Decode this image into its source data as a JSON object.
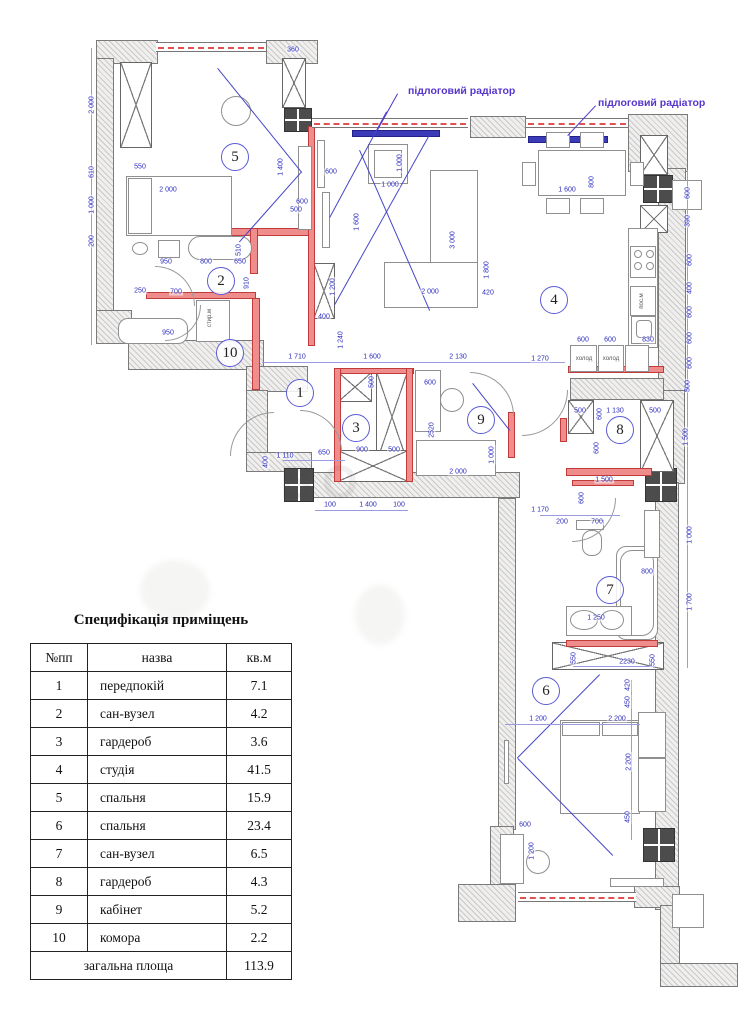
{
  "colors": {
    "dimension_blue": "#2a2ac0",
    "wall_red": "#ef8d8d",
    "radiator_blue": "#3b3bb8",
    "label_violet": "#5535cc"
  },
  "plan": {
    "watermark": "ВО",
    "radiator_labels": [
      {
        "t": "підлоговий радіатор",
        "x": 408,
        "y": 85
      },
      {
        "t": "підлоговий радіатор",
        "x": 598,
        "y": 97
      }
    ],
    "rooms": [
      {
        "n": "1",
        "x": 300,
        "y": 393
      },
      {
        "n": "2",
        "x": 221,
        "y": 281
      },
      {
        "n": "3",
        "x": 356,
        "y": 428
      },
      {
        "n": "4",
        "x": 554,
        "y": 300
      },
      {
        "n": "5",
        "x": 235,
        "y": 157
      },
      {
        "n": "6",
        "x": 546,
        "y": 691
      },
      {
        "n": "7",
        "x": 610,
        "y": 590
      },
      {
        "n": "8",
        "x": 620,
        "y": 430
      },
      {
        "n": "9",
        "x": 481,
        "y": 420
      },
      {
        "n": "10",
        "x": 230,
        "y": 353
      }
    ],
    "small_labels": [
      {
        "t": "стир.м",
        "x": 210,
        "y": 318,
        "v": 1
      },
      {
        "t": "пос.м",
        "x": 642,
        "y": 301,
        "v": 1
      },
      {
        "t": "холод",
        "x": 584,
        "y": 359
      },
      {
        "t": "холод",
        "x": 611,
        "y": 359
      }
    ],
    "dims": [
      {
        "t": "2 000",
        "x": 92,
        "y": 105,
        "v": 1
      },
      {
        "t": "610",
        "x": 92,
        "y": 172,
        "v": 1
      },
      {
        "t": "1 000",
        "x": 92,
        "y": 205,
        "v": 1
      },
      {
        "t": "200",
        "x": 92,
        "y": 241,
        "v": 1
      },
      {
        "t": "550",
        "x": 140,
        "y": 167
      },
      {
        "t": "2 000",
        "x": 168,
        "y": 190
      },
      {
        "t": "360",
        "x": 293,
        "y": 50
      },
      {
        "t": "1 400",
        "x": 281,
        "y": 167,
        "v": 1
      },
      {
        "t": "600",
        "x": 331,
        "y": 172
      },
      {
        "t": "600",
        "x": 302,
        "y": 202
      },
      {
        "t": "500",
        "x": 296,
        "y": 210
      },
      {
        "t": "250",
        "x": 140,
        "y": 291
      },
      {
        "t": "950",
        "x": 166,
        "y": 262
      },
      {
        "t": "800",
        "x": 206,
        "y": 262
      },
      {
        "t": "650",
        "x": 240,
        "y": 262
      },
      {
        "t": "510",
        "x": 239,
        "y": 250,
        "v": 1
      },
      {
        "t": "910",
        "x": 247,
        "y": 283,
        "v": 1
      },
      {
        "t": "700",
        "x": 176,
        "y": 292
      },
      {
        "t": "950",
        "x": 168,
        "y": 333
      },
      {
        "t": "1 200",
        "x": 333,
        "y": 287,
        "v": 1
      },
      {
        "t": "400",
        "x": 324,
        "y": 317
      },
      {
        "t": "1 240",
        "x": 341,
        "y": 340,
        "v": 1
      },
      {
        "t": "1 710",
        "x": 297,
        "y": 357
      },
      {
        "t": "1 600",
        "x": 372,
        "y": 357
      },
      {
        "t": "2 130",
        "x": 458,
        "y": 357
      },
      {
        "t": "1 270",
        "x": 540,
        "y": 359
      },
      {
        "t": "1 110",
        "x": 285,
        "y": 456
      },
      {
        "t": "650",
        "x": 324,
        "y": 453
      },
      {
        "t": "400",
        "x": 266,
        "y": 462,
        "v": 1
      },
      {
        "t": "900",
        "x": 362,
        "y": 450
      },
      {
        "t": "500",
        "x": 394,
        "y": 450
      },
      {
        "t": "500",
        "x": 372,
        "y": 382,
        "v": 1
      },
      {
        "t": "100",
        "x": 330,
        "y": 505
      },
      {
        "t": "1 400",
        "x": 368,
        "y": 505
      },
      {
        "t": "100",
        "x": 399,
        "y": 505
      },
      {
        "t": "600",
        "x": 430,
        "y": 383
      },
      {
        "t": "2520",
        "x": 432,
        "y": 430,
        "v": 1
      },
      {
        "t": "2 000",
        "x": 458,
        "y": 472
      },
      {
        "t": "1 000",
        "x": 492,
        "y": 455,
        "v": 1
      },
      {
        "t": "1 000",
        "x": 390,
        "y": 185
      },
      {
        "t": "1 000",
        "x": 400,
        "y": 163,
        "v": 1
      },
      {
        "t": "1 600",
        "x": 357,
        "y": 222,
        "v": 1
      },
      {
        "t": "3 000",
        "x": 453,
        "y": 240,
        "v": 1
      },
      {
        "t": "1 800",
        "x": 487,
        "y": 270,
        "v": 1
      },
      {
        "t": "2 000",
        "x": 430,
        "y": 292
      },
      {
        "t": "420",
        "x": 488,
        "y": 293
      },
      {
        "t": "1 600",
        "x": 567,
        "y": 190
      },
      {
        "t": "800",
        "x": 592,
        "y": 182,
        "v": 1
      },
      {
        "t": "600",
        "x": 688,
        "y": 193,
        "v": 1
      },
      {
        "t": "390",
        "x": 688,
        "y": 221,
        "v": 1
      },
      {
        "t": "600",
        "x": 690,
        "y": 260,
        "v": 1
      },
      {
        "t": "400",
        "x": 690,
        "y": 288,
        "v": 1
      },
      {
        "t": "600",
        "x": 690,
        "y": 312,
        "v": 1
      },
      {
        "t": "600",
        "x": 690,
        "y": 338,
        "v": 1
      },
      {
        "t": "600",
        "x": 690,
        "y": 363,
        "v": 1
      },
      {
        "t": "500",
        "x": 688,
        "y": 386,
        "v": 1
      },
      {
        "t": "830",
        "x": 648,
        "y": 340
      },
      {
        "t": "600",
        "x": 583,
        "y": 340
      },
      {
        "t": "600",
        "x": 610,
        "y": 340
      },
      {
        "t": "500",
        "x": 580,
        "y": 411
      },
      {
        "t": "1 130",
        "x": 615,
        "y": 411
      },
      {
        "t": "500",
        "x": 655,
        "y": 411
      },
      {
        "t": "600",
        "x": 600,
        "y": 414,
        "v": 1
      },
      {
        "t": "1 500",
        "x": 686,
        "y": 437,
        "v": 1
      },
      {
        "t": "600",
        "x": 597,
        "y": 448,
        "v": 1
      },
      {
        "t": "1 500",
        "x": 604,
        "y": 480
      },
      {
        "t": "1 170",
        "x": 540,
        "y": 510
      },
      {
        "t": "200",
        "x": 562,
        "y": 522
      },
      {
        "t": "700",
        "x": 597,
        "y": 522
      },
      {
        "t": "600",
        "x": 582,
        "y": 498,
        "v": 1
      },
      {
        "t": "1 000",
        "x": 690,
        "y": 535,
        "v": 1
      },
      {
        "t": "800",
        "x": 647,
        "y": 572
      },
      {
        "t": "1 700",
        "x": 690,
        "y": 602,
        "v": 1
      },
      {
        "t": "1 250",
        "x": 596,
        "y": 618
      },
      {
        "t": "550",
        "x": 574,
        "y": 658,
        "v": 1
      },
      {
        "t": "2230",
        "x": 627,
        "y": 662
      },
      {
        "t": "550",
        "x": 653,
        "y": 660,
        "v": 1
      },
      {
        "t": "420",
        "x": 628,
        "y": 685,
        "v": 1
      },
      {
        "t": "450",
        "x": 628,
        "y": 702,
        "v": 1
      },
      {
        "t": "1 200",
        "x": 538,
        "y": 719
      },
      {
        "t": "2 200",
        "x": 617,
        "y": 719
      },
      {
        "t": "2 200",
        "x": 629,
        "y": 762,
        "v": 1
      },
      {
        "t": "450",
        "x": 628,
        "y": 817,
        "v": 1
      },
      {
        "t": "600",
        "x": 525,
        "y": 825
      },
      {
        "t": "1 200",
        "x": 532,
        "y": 851,
        "v": 1
      }
    ]
  },
  "spec": {
    "title": "Специфікація приміщень",
    "columns": [
      "№пп",
      "назва",
      "кв.м"
    ],
    "rows": [
      [
        "1",
        "передпокій",
        "7.1"
      ],
      [
        "2",
        "сан-вузел",
        "4.2"
      ],
      [
        "3",
        "гардероб",
        "3.6"
      ],
      [
        "4",
        "студія",
        "41.5"
      ],
      [
        "5",
        "спальня",
        "15.9"
      ],
      [
        "6",
        "спальня",
        "23.4"
      ],
      [
        "7",
        "сан-вузел",
        "6.5"
      ],
      [
        "8",
        "гардероб",
        "4.3"
      ],
      [
        "9",
        "кабінет",
        "5.2"
      ],
      [
        "10",
        "комора",
        "2.2"
      ]
    ],
    "total_row": [
      "загальна площа",
      "113.9"
    ]
  }
}
